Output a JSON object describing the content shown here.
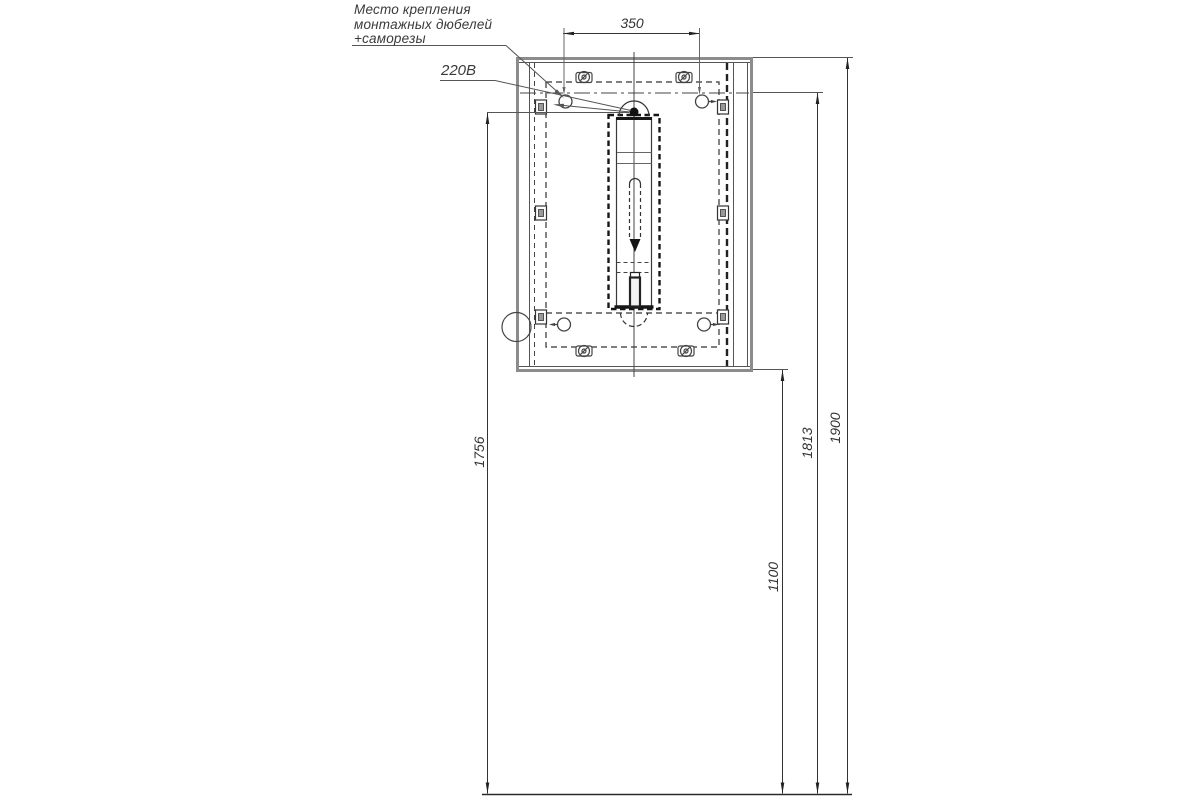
{
  "drawing": {
    "note": {
      "line1": "Место крепления",
      "line2": "монтажных дюбелей",
      "line3": "+саморезы"
    },
    "power_label": "220В",
    "dimensions": {
      "dowel_spacing_width": "350",
      "outlet_height": "1756",
      "cabinet_bottom_height": "1100",
      "dowel_height": "1813",
      "cabinet_top_height": "1900"
    }
  },
  "colors": {
    "background": "#ffffff",
    "thin_line": "#3c3c3c",
    "thick_edge": "#8c8c8c",
    "text": "#3a3a3a"
  }
}
